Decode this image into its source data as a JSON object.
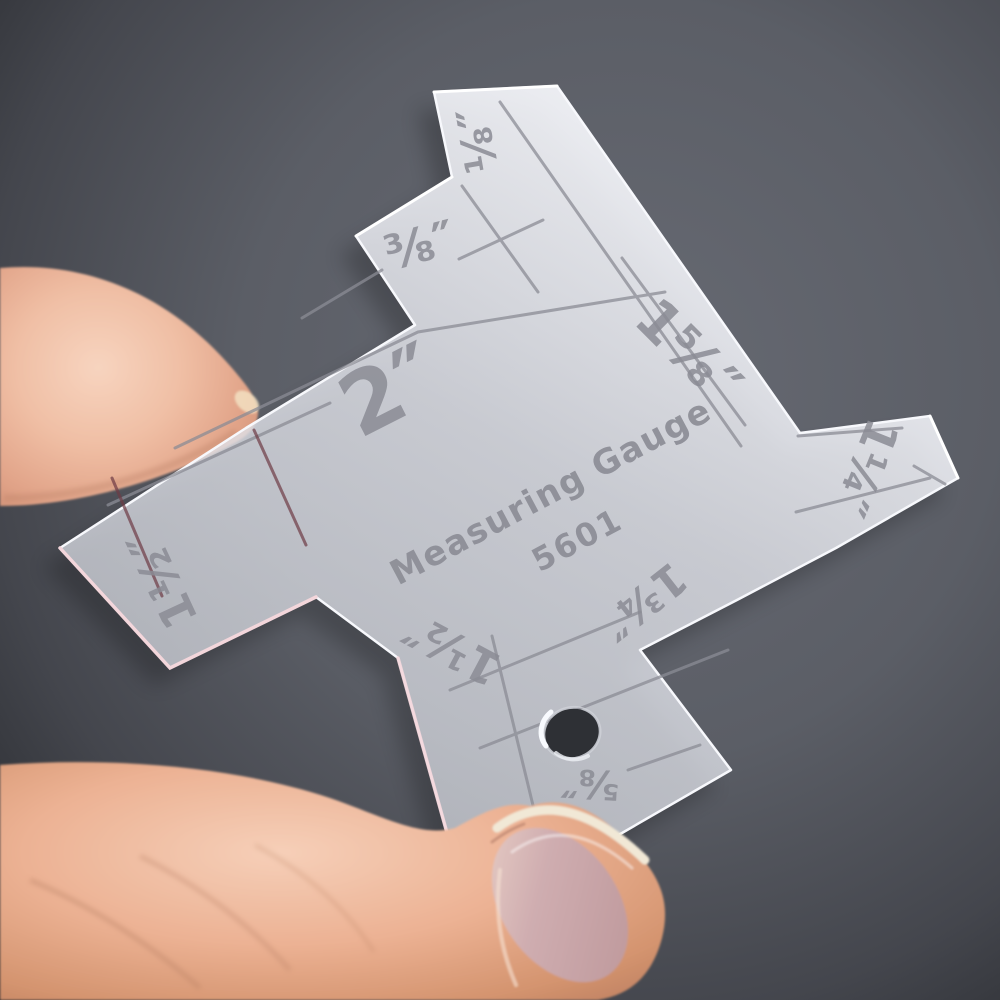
{
  "scene": {
    "description": "Photograph of a thumb and index finger holding a transparent acrylic seam measuring gauge against a dark gray background"
  },
  "gauge": {
    "title": "Measuring Gauge",
    "model": "5601",
    "markings": [
      {
        "id": "eighth-inch-top-tab",
        "text": "⅛″"
      },
      {
        "id": "three-eighths-inch-step",
        "text": "⅜″"
      },
      {
        "id": "two-inch",
        "text": "2″"
      },
      {
        "id": "one-and-five-eighths-inch",
        "text": "1⅝″"
      },
      {
        "id": "one-and-quarter-inch-right-arm",
        "text": "1¼″"
      },
      {
        "id": "one-and-half-inch-left-arm",
        "text": "1½″"
      },
      {
        "id": "one-and-half-inch-bottom-arm",
        "text": "1½″"
      },
      {
        "id": "one-and-three-quarters-inch",
        "text": "1¾″"
      },
      {
        "id": "five-eighths-inch-near-hole",
        "text": "⅝″"
      }
    ],
    "colors": {
      "acrylic": "#e7e9f0",
      "engraving": "#8b8c95",
      "edge_highlight": "#f7f8fc",
      "edge_pink": "#f3d6db"
    }
  },
  "background": {
    "center": "#62656e",
    "edge": "#2b2d32"
  },
  "hand": {
    "skin_light": "#f6d2bd",
    "skin_dark": "#c9886d",
    "nail": "#c9a8ab",
    "nail_rim": "#f1e8d6"
  }
}
